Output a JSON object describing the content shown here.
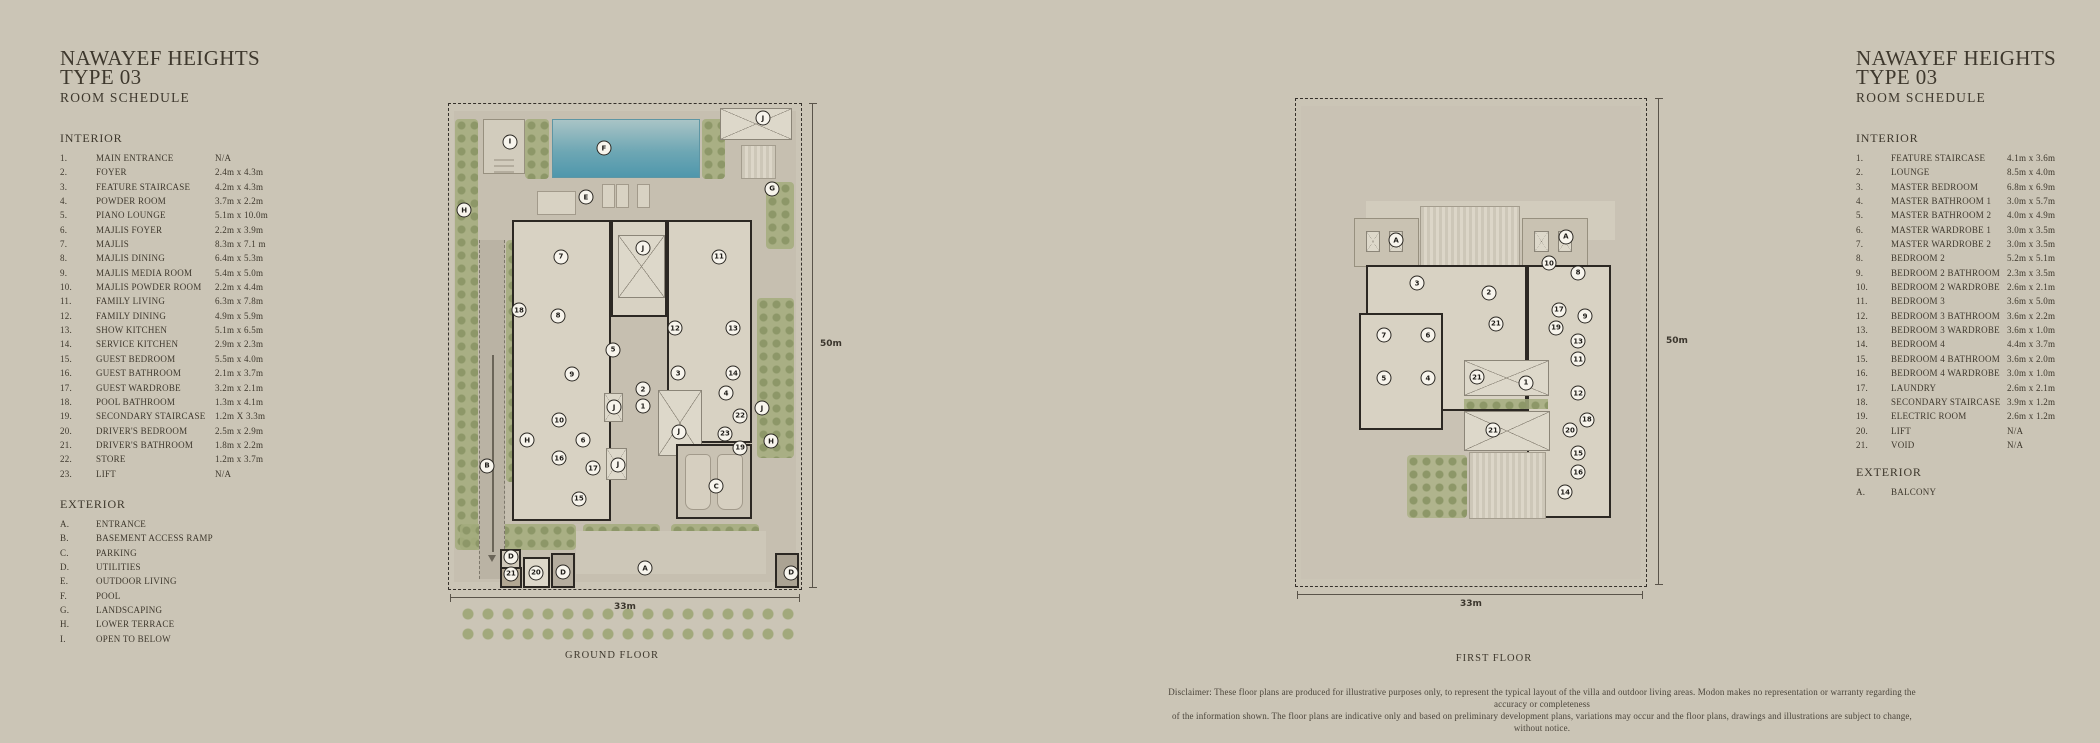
{
  "colors": {
    "background": "#cbc5b6",
    "text": "#3e382d",
    "wall": "#2c2823",
    "pool": "#5f9fae",
    "green": "#a3ab7c",
    "boundary": "#35302a"
  },
  "left_schedule": {
    "title": "NAWAYEF HEIGHTS\nTYPE 03",
    "subtitle": "ROOM SCHEDULE",
    "interior_heading": "INTERIOR",
    "exterior_heading": "EXTERIOR",
    "interior": [
      [
        "1.",
        "MAIN ENTRANCE",
        "N/A"
      ],
      [
        "2.",
        "FOYER",
        "2.4m x 4.3m"
      ],
      [
        "3.",
        "FEATURE STAIRCASE",
        "4.2m x 4.3m"
      ],
      [
        "4.",
        "POWDER ROOM",
        "3.7m x 2.2m"
      ],
      [
        "5.",
        "PIANO LOUNGE",
        "5.1m x 10.0m"
      ],
      [
        "6.",
        "MAJLIS FOYER",
        "2.2m x 3.9m"
      ],
      [
        "7.",
        "MAJLIS",
        "8.3m x 7.1 m"
      ],
      [
        "8.",
        "MAJLIS DINING",
        "6.4m x 5.3m"
      ],
      [
        "9.",
        "MAJLIS MEDIA ROOM",
        "5.4m x 5.0m"
      ],
      [
        "10.",
        "MAJLIS POWDER ROOM",
        "2.2m x 4.4m"
      ],
      [
        "11.",
        "FAMILY LIVING",
        "6.3m x 7.8m"
      ],
      [
        "12.",
        "FAMILY DINING",
        "4.9m x 5.9m"
      ],
      [
        "13.",
        "SHOW KITCHEN",
        "5.1m x 6.5m"
      ],
      [
        "14.",
        "SERVICE KITCHEN",
        "2.9m x 2.3m"
      ],
      [
        "15.",
        "GUEST BEDROOM",
        "5.5m x 4.0m"
      ],
      [
        "16.",
        "GUEST BATHROOM",
        "2.1m x 3.7m"
      ],
      [
        "17.",
        "GUEST WARDROBE",
        "3.2m x 2.1m"
      ],
      [
        "18.",
        "POOL BATHROOM",
        "1.3m x 4.1m"
      ],
      [
        "19.",
        "SECONDARY STAIRCASE",
        "1.2m X 3.3m"
      ],
      [
        "20.",
        "DRIVER'S BEDROOM",
        "2.5m x 2.9m"
      ],
      [
        "21.",
        "DRIVER'S BATHROOM",
        "1.8m x 2.2m"
      ],
      [
        "22.",
        "STORE",
        "1.2m x 3.7m"
      ],
      [
        "23.",
        "LIFT",
        "N/A"
      ]
    ],
    "exterior": [
      [
        "A.",
        "ENTRANCE"
      ],
      [
        "B.",
        "BASEMENT ACCESS RAMP"
      ],
      [
        "C.",
        "PARKING"
      ],
      [
        "D.",
        "UTILITIES"
      ],
      [
        "E.",
        "OUTDOOR LIVING"
      ],
      [
        "F.",
        "POOL"
      ],
      [
        "G.",
        "LANDSCAPING"
      ],
      [
        "H.",
        "LOWER TERRACE"
      ],
      [
        "I.",
        "OPEN TO BELOW"
      ]
    ]
  },
  "right_schedule": {
    "title": "NAWAYEF HEIGHTS\nTYPE 03",
    "subtitle": "ROOM SCHEDULE",
    "interior_heading": "INTERIOR",
    "exterior_heading": "EXTERIOR",
    "interior": [
      [
        "1.",
        "FEATURE STAIRCASE",
        "4.1m x 3.6m"
      ],
      [
        "2.",
        "LOUNGE",
        "8.5m x 4.0m"
      ],
      [
        "3.",
        "MASTER BEDROOM",
        "6.8m x 6.9m"
      ],
      [
        "4.",
        "MASTER BATHROOM 1",
        "3.0m x 5.7m"
      ],
      [
        "5.",
        "MASTER BATHROOM 2",
        "4.0m x 4.9m"
      ],
      [
        "6.",
        "MASTER WARDROBE 1",
        "3.0m x 3.5m"
      ],
      [
        "7.",
        "MASTER WARDROBE 2",
        "3.0m x 3.5m"
      ],
      [
        "8.",
        "BEDROOM 2",
        "5.2m x 5.1m"
      ],
      [
        "9.",
        "BEDROOM 2 BATHROOM",
        "2.3m x 3.5m"
      ],
      [
        "10.",
        "BEDROOM 2 WARDROBE",
        "2.6m x 2.1m"
      ],
      [
        "11.",
        "BEDROOM 3",
        "3.6m x 5.0m"
      ],
      [
        "12.",
        "BEDROOM 3 BATHROOM",
        "3.6m x 2.2m"
      ],
      [
        "13.",
        "BEDROOM 3 WARDROBE",
        "3.6m x 1.0m"
      ],
      [
        "14.",
        "BEDROOM 4",
        "4.4m x 3.7m"
      ],
      [
        "15.",
        "BEDROOM 4 BATHROOM",
        "3.6m x 2.0m"
      ],
      [
        "16.",
        "BEDROOM 4 WARDROBE",
        "3.0m x 1.0m"
      ],
      [
        "17.",
        "LAUNDRY",
        "2.6m x 2.1m"
      ],
      [
        "18.",
        "SECONDARY STAIRCASE",
        "3.9m x 1.2m"
      ],
      [
        "19.",
        "ELECTRIC ROOM",
        "2.6m x 1.2m"
      ],
      [
        "20.",
        "LIFT",
        "N/A"
      ],
      [
        "21.",
        "VOID",
        "N/A"
      ]
    ],
    "exterior": [
      [
        "A.",
        "BALCONY"
      ]
    ]
  },
  "ground_floor": {
    "label": "GROUND FLOOR",
    "height_label": "50m",
    "width_label": "33m",
    "markers": [
      [
        "I",
        17.3,
        7.8
      ],
      [
        "F",
        44.0,
        9.1
      ],
      [
        "J",
        89.2,
        2.9
      ],
      [
        "E",
        38.9,
        19.2
      ],
      [
        "G",
        91.8,
        17.5
      ],
      [
        "H",
        4.3,
        21.9
      ],
      [
        "7",
        31.8,
        31.5
      ],
      [
        "J",
        55.1,
        29.7
      ],
      [
        "11",
        76.7,
        31.5
      ],
      [
        "18",
        19.9,
        42.5
      ],
      [
        "8",
        31.0,
        43.7
      ],
      [
        "12",
        64.2,
        46.2
      ],
      [
        "13",
        80.7,
        46.2
      ],
      [
        "5",
        46.6,
        50.7
      ],
      [
        "9",
        34.9,
        55.7
      ],
      [
        "3",
        65.1,
        55.5
      ],
      [
        "2",
        55.1,
        58.8
      ],
      [
        "1",
        55.1,
        62.3
      ],
      [
        "J",
        46.9,
        62.5
      ],
      [
        "14",
        80.7,
        55.5
      ],
      [
        "4",
        78.7,
        59.6
      ],
      [
        "10",
        31.3,
        65.2
      ],
      [
        "22",
        82.7,
        64.3
      ],
      [
        "J",
        88.9,
        62.7
      ],
      [
        "H",
        22.2,
        69.3
      ],
      [
        "B",
        10.8,
        74.6
      ],
      [
        "6",
        38.1,
        69.3
      ],
      [
        "23",
        78.4,
        68.0
      ],
      [
        "J",
        65.3,
        67.6
      ],
      [
        "16",
        31.3,
        73.0
      ],
      [
        "19",
        82.7,
        70.9
      ],
      [
        "17",
        40.9,
        75.1
      ],
      [
        "J",
        48.0,
        74.4
      ],
      [
        "H",
        91.5,
        69.5
      ],
      [
        "C",
        75.9,
        78.8
      ],
      [
        "15",
        36.9,
        81.4
      ],
      [
        "D",
        17.6,
        93.4
      ],
      [
        "21",
        17.6,
        96.9
      ],
      [
        "20",
        24.7,
        96.7
      ],
      [
        "D",
        32.4,
        96.5
      ],
      [
        "A",
        55.7,
        95.7
      ],
      [
        "D",
        97.2,
        96.7
      ]
    ]
  },
  "first_floor": {
    "label": "FIRST FLOOR",
    "height_label": "50m",
    "width_label": "33m",
    "markers": [
      [
        "A",
        28.6,
        29.0
      ],
      [
        "A",
        77.1,
        28.3
      ],
      [
        "3",
        34.6,
        37.8
      ],
      [
        "10",
        72.3,
        33.7
      ],
      [
        "8",
        80.6,
        35.7
      ],
      [
        "2",
        55.1,
        39.8
      ],
      [
        "17",
        75.1,
        43.3
      ],
      [
        "9",
        82.6,
        44.6
      ],
      [
        "19",
        74.3,
        47.0
      ],
      [
        "13",
        80.6,
        49.7
      ],
      [
        "21",
        57.1,
        46.2
      ],
      [
        "7",
        25.1,
        48.5
      ],
      [
        "6",
        37.7,
        48.5
      ],
      [
        "11",
        80.6,
        53.4
      ],
      [
        "5",
        25.1,
        57.3
      ],
      [
        "4",
        37.7,
        57.3
      ],
      [
        "21",
        51.7,
        57.1
      ],
      [
        "1",
        65.7,
        58.3
      ],
      [
        "12",
        80.6,
        60.4
      ],
      [
        "18",
        83.1,
        65.9
      ],
      [
        "20",
        78.3,
        68.0
      ],
      [
        "21",
        56.3,
        68.0
      ],
      [
        "15",
        80.6,
        72.7
      ],
      [
        "16",
        80.6,
        76.6
      ],
      [
        "14",
        76.9,
        80.7
      ]
    ]
  },
  "disclaimer": {
    "line1": "Disclaimer: These floor plans are produced for illustrative purposes only, to represent the typical layout of the villa and outdoor living areas.  Modon makes no representation or warranty regarding the accuracy or completeness",
    "line2": "of the information shown.  The floor plans are indicative only and based on preliminary development plans, variations may occur and the floor plans, drawings and illustrations are subject to change, without notice."
  }
}
